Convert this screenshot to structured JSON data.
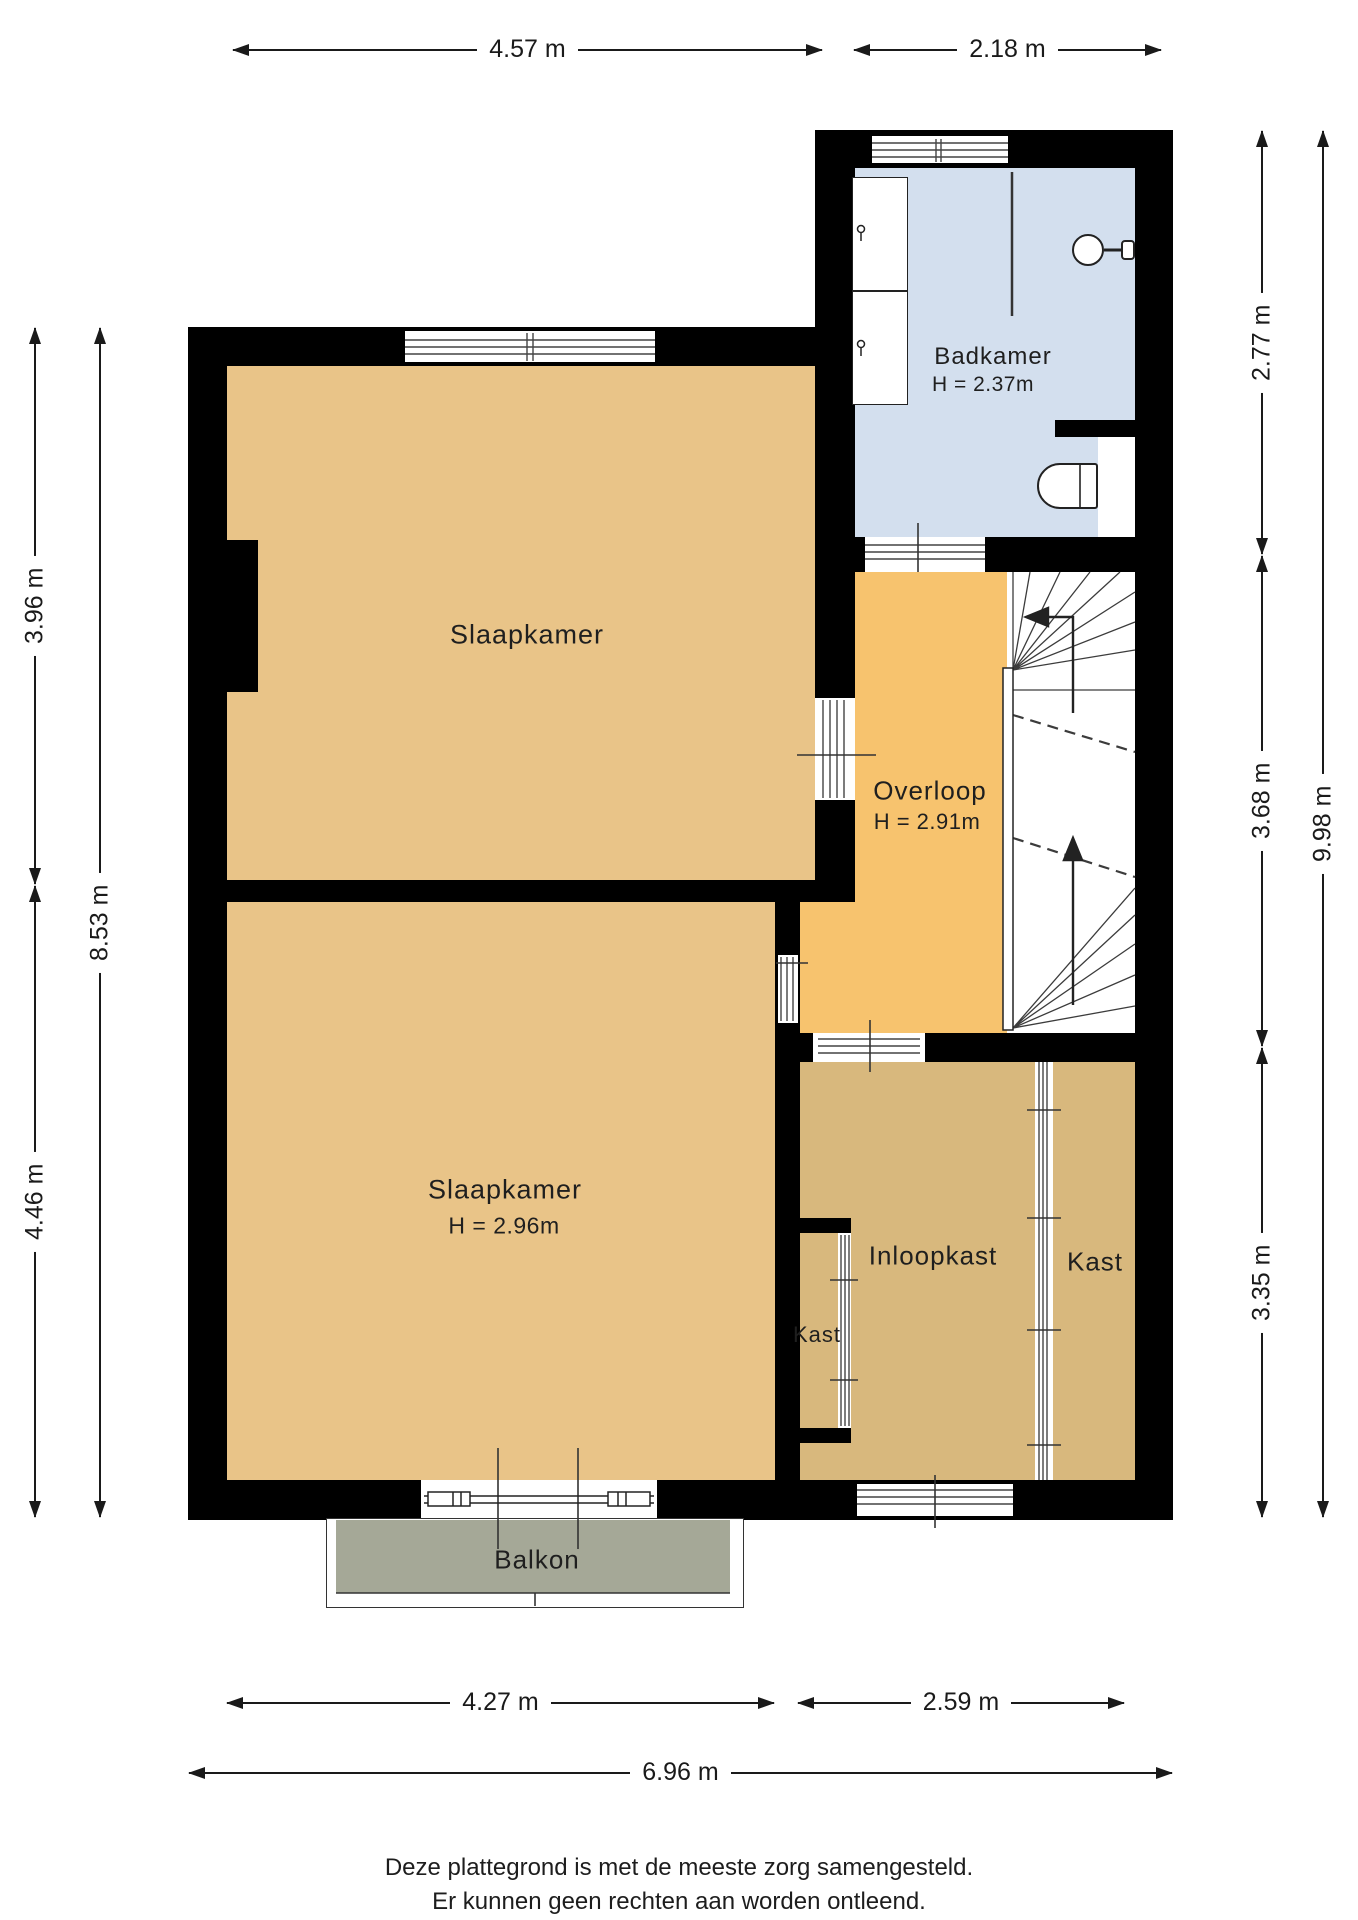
{
  "plan": {
    "rooms": {
      "bedroom1": {
        "name": "Slaapkamer"
      },
      "bedroom2": {
        "name": "Slaapkamer",
        "height": "H = 2.96m"
      },
      "bathroom": {
        "name": "Badkamer",
        "height": "H = 2.37m"
      },
      "landing": {
        "name": "Overloop",
        "height": "H = 2.91m"
      },
      "closet_small": {
        "name": "Kast"
      },
      "walk_in_closet": {
        "name": "Inloopkast"
      },
      "closet_right": {
        "name": "Kast"
      },
      "balcony": {
        "name": "Balkon"
      }
    },
    "dimensions": {
      "top_left": "4.57 m",
      "top_right": "2.18 m",
      "left_upper": "3.96 m",
      "left_lower": "4.46 m",
      "left_total": "8.53 m",
      "right_upper": "2.77 m",
      "right_middle": "3.68 m",
      "right_lower": "3.35 m",
      "right_total": "9.98 m",
      "bottom_left": "4.27 m",
      "bottom_right": "2.59 m",
      "bottom_total": "6.96 m"
    },
    "disclaimer": {
      "line1": "Deze plattegrond is met de meeste zorg samengesteld.",
      "line2": "Er kunnen geen rechten aan worden ontleend."
    },
    "colors": {
      "bedroom": "#e9c488",
      "landing": "#f7c36e",
      "closet": "#d8b87d",
      "bathroom": "#d3dfee",
      "balcony": "#a5a897",
      "wall": "#000000",
      "line": "#3a3a3a",
      "text": "#1a1a1a"
    }
  }
}
